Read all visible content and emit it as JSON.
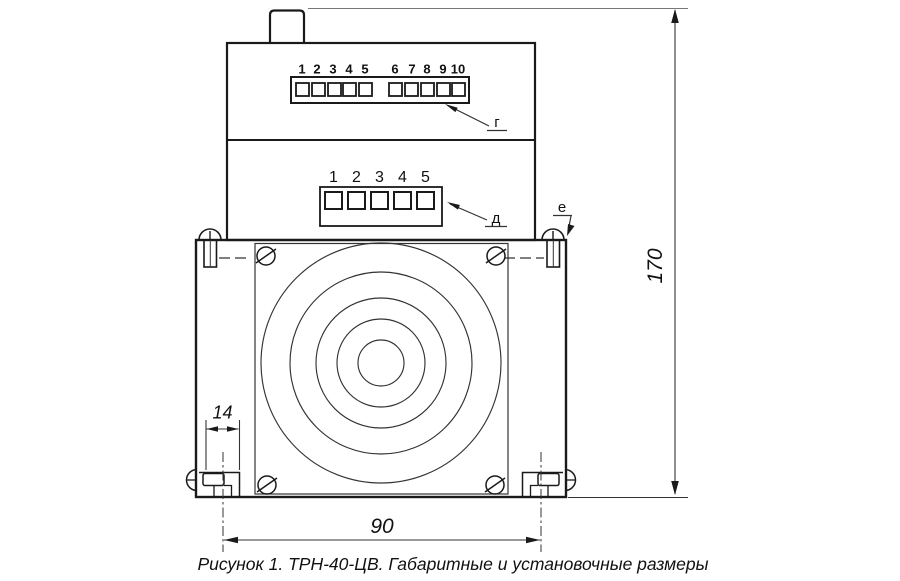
{
  "caption": "Рисунок 1. ТРН-40-ЦВ. Габаритные и установочные размеры",
  "top_terminal_block": {
    "leader_label": "г",
    "numbers": [
      "1",
      "2",
      "3",
      "4",
      "5",
      "6",
      "7",
      "8",
      "9",
      "10"
    ]
  },
  "mid_terminal_block": {
    "leader_label": "д",
    "numbers": [
      "1",
      "2",
      "3",
      "4",
      "5"
    ]
  },
  "fastener": {
    "leader_label": "е"
  },
  "dimensions": {
    "overall_height": "170",
    "foot_width": "14",
    "mounting_span": "90"
  },
  "colors": {
    "ink": "#1a1a1a",
    "thin_line": "#333333",
    "background": "#ffffff"
  }
}
